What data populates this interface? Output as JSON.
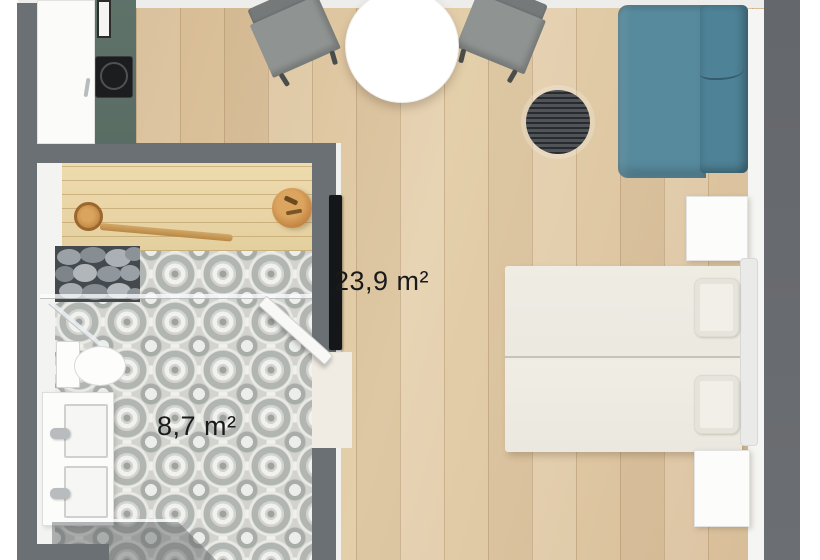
{
  "scene": {
    "type": "apartment-floor-plan-top-view-3d",
    "labels": {
      "main_room_area": "23,9 m²",
      "bathroom_area": "8,7 m²"
    },
    "rooms": [
      {
        "id": "living-room",
        "area": "23,9 m²",
        "floor": "light-oak-planks"
      },
      {
        "id": "bathroom-sauna",
        "area": "8,7 m²",
        "floor": "gray-patterned-tiles"
      }
    ],
    "furniture": [
      "round-dining-table",
      "dining-chair-left",
      "dining-chair-right",
      "teal-sofa",
      "round-dark-rug",
      "double-bed",
      "pillow-left",
      "pillow-right",
      "headboard",
      "nightstand-upper",
      "nightstand-lower",
      "tall-cabinet",
      "green-kitchen-counter",
      "cooktop",
      "kitchen-sink",
      "sauna-bench",
      "sauna-ladle",
      "sauna-bucket",
      "sauna-heater-stones",
      "glass-partition",
      "shower-area",
      "toilet",
      "double-sink-vanity",
      "bathroom-door",
      "wall-mounted-tv"
    ],
    "colors": {
      "wall": "#6a7074",
      "wood_floor": "#dcc19c",
      "bench_wood": "#e9d5a8",
      "counter_green": "#5d7067",
      "sofa_teal": "#538599",
      "rug_dark": "#3f4549",
      "tile_gray": "#d2d2ce",
      "label_text": "#1a1a1a"
    }
  }
}
